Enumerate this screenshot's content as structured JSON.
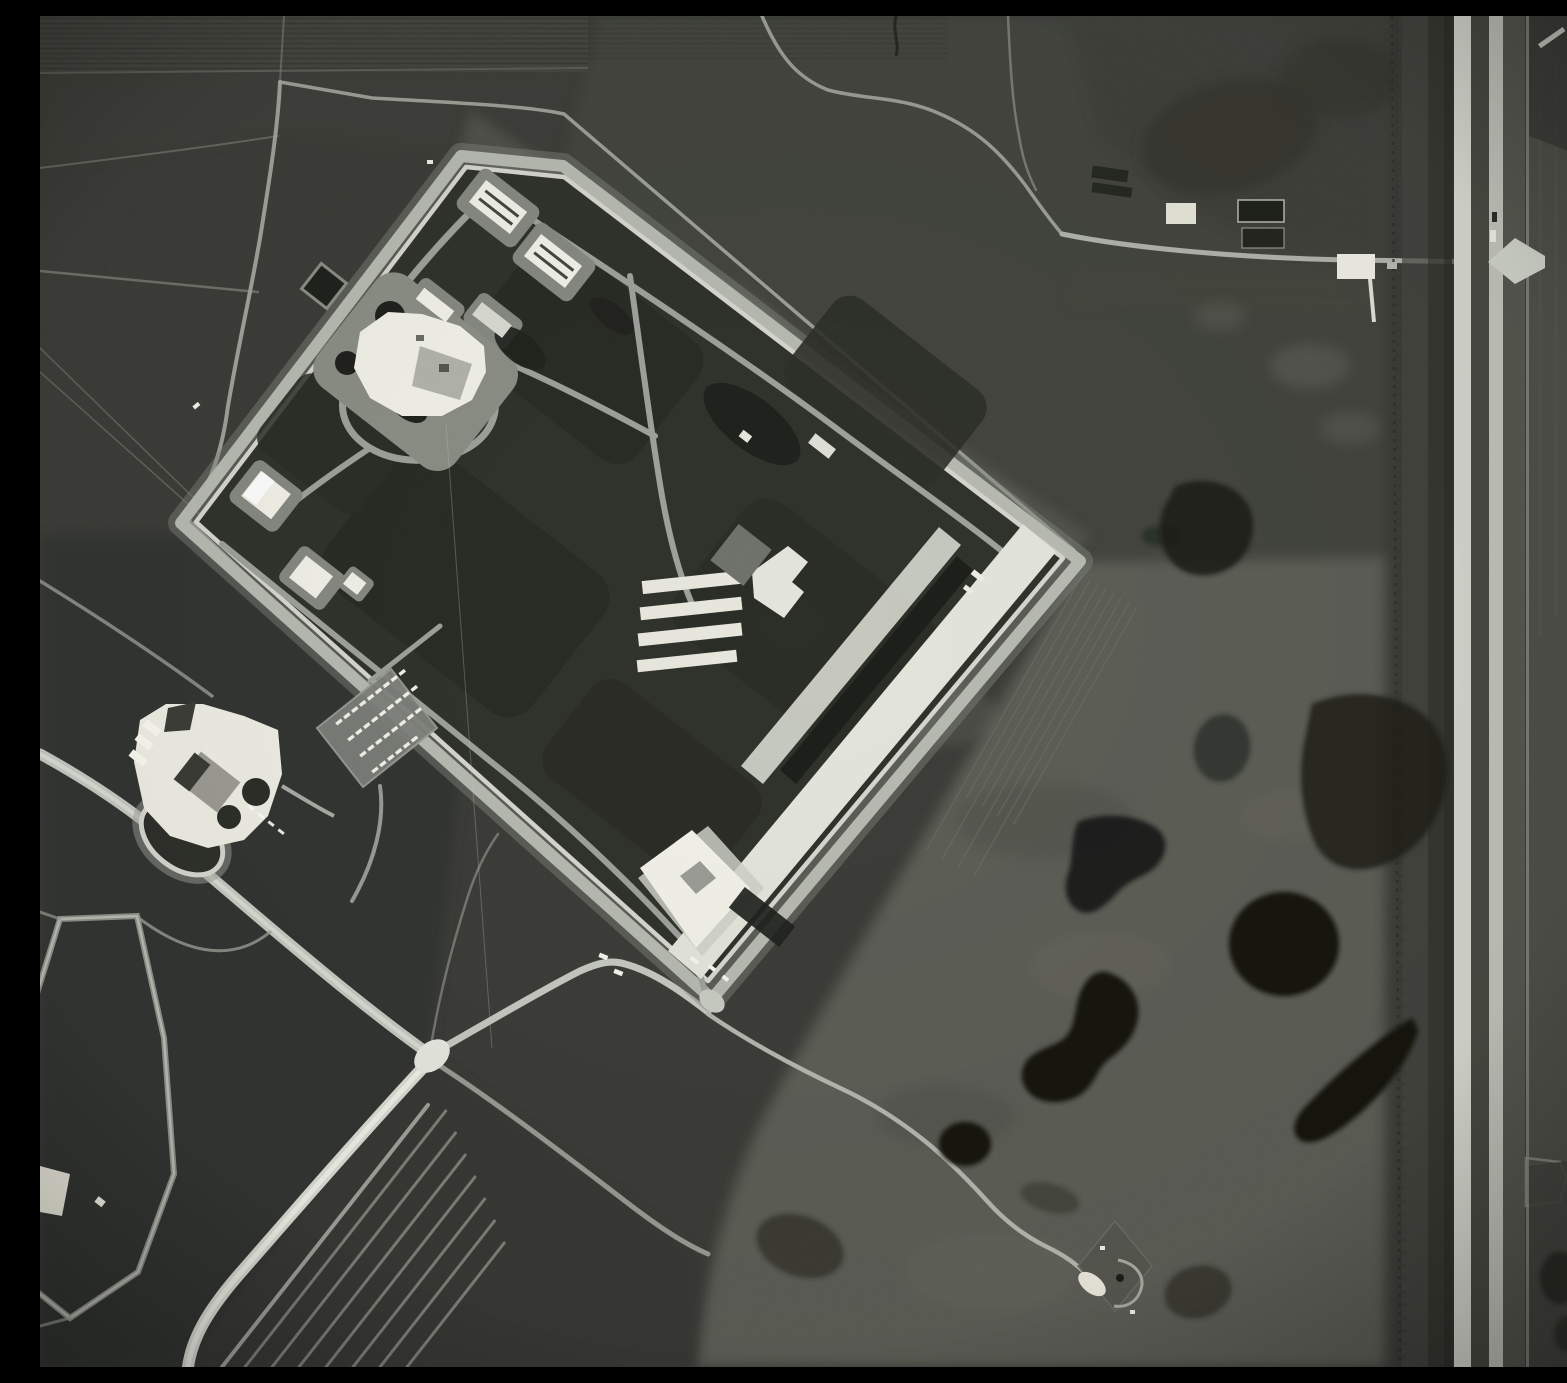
{
  "image": {
    "kind": "black-and-white overhead aerial photograph",
    "width_px": 1567,
    "height_px": 1351,
    "description": "Grayscale reconnaissance-style photo of a diamond-shaped fenced compound with interior roads and white-roofed buildings, a support complex and vehicle parking outside its southwest fence, a bright X-shaped road intersection lower left, looped vehicle tracks at bottom, pothole ponds in open pasture, a small diamond pad site lower center-right, a farmstead upper right, and a divided highway running vertically along the right edge."
  },
  "palette": {
    "field_dark": "#343530",
    "field_mid": "#3c3d38",
    "field_upper": "#45463f",
    "pasture": "#5c5d55",
    "pasture_light": "#6a6b62",
    "compound_interior": "#30322c",
    "block_dark": "#292b25",
    "road_light": "#9da19a",
    "road_bright": "#c6c9c0",
    "road_brightest": "#dadcd3",
    "apron_white": "#e4e6dc",
    "building_white": "#f2f2e8",
    "building_gray": "#9b9b93",
    "pond_dark": "#141511",
    "highway_pavement": "#d4d6cd",
    "highway_median": "#474840",
    "shadow_dark": "#20221d"
  },
  "features": {
    "compound": {
      "name": "fenced compound",
      "perimeter": "double fence line with patrol road, five-cornered rotated diamond",
      "striped_barracks_count": 2,
      "small_barracks_count": 2,
      "garage_row_bays": 4,
      "has_headquarters_building": true,
      "has_long_warehouse_with_aprons": true,
      "gate_position": "south corner"
    },
    "support_complex": {
      "name": "white support complex",
      "has_oval_drive_loop": true,
      "dark_courtyard_circles": 2
    },
    "parking_lot": {
      "rows": [
        9,
        9,
        8,
        6
      ]
    },
    "loop_tracks": {
      "count": 7
    },
    "crop_strips": {
      "count": 8
    },
    "intersection": {
      "shape": "X",
      "radiating_roads": 6
    },
    "pad_site": {
      "shape": "rotated square pad with loop drive and bright apron"
    },
    "farmstead": {
      "buildings": [
        "white barn",
        "two dark sheds",
        "white farmhouse"
      ],
      "has_driveway": true
    },
    "highway": {
      "orientation": "vertical",
      "carriageways": 2,
      "junction": "flared at-grade crossing upper right",
      "vehicles_visible": 2
    },
    "ponds": {
      "count": 9,
      "names": [
        "peanut pond",
        "round pond east",
        "crescent pond",
        "faint kidney pond",
        "hook pond",
        "small round pond",
        "faint pond by pad site",
        "large dark patch by highway",
        "dark pond northeast of compound"
      ]
    },
    "vehicles": {
      "white_trucks_on_gate_road": 2,
      "white_trucks_inside_gate": 3
    }
  }
}
